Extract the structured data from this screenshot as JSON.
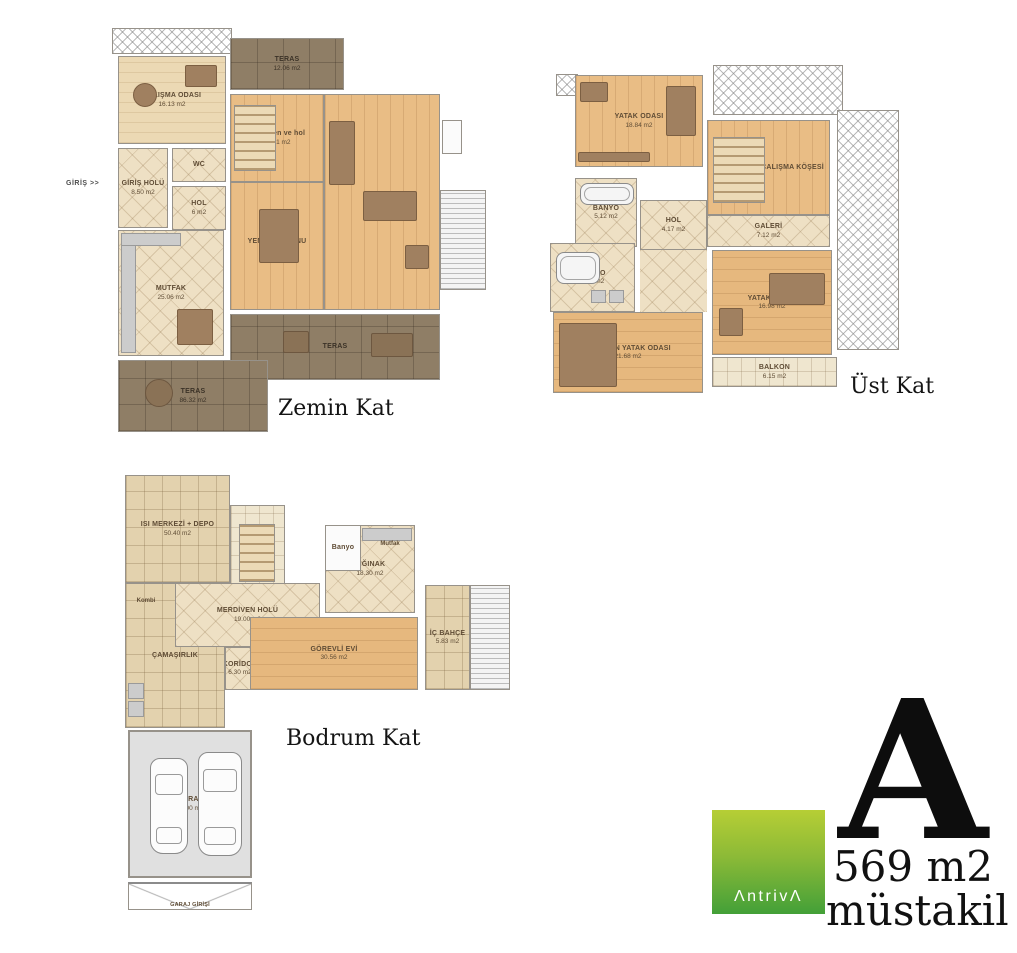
{
  "palette": {
    "wood": "#e9bd85",
    "wood_pale": "#ecd9b4",
    "tile": "#eee0c4",
    "terrace": "#8f7e66",
    "garage_floor": "#e0e0e0",
    "logo_green_top": "#b6ce35",
    "logo_green_bottom": "#43a038"
  },
  "logo": {
    "brand": "ΛntrivΛ",
    "unit_letter": "A",
    "unit_area": "569 m2",
    "unit_type": "müstakil"
  },
  "floors": {
    "zemin": {
      "title": "Zemin Kat",
      "entry": "GİRİŞ >>",
      "rooms": {
        "calisma": {
          "label": "ÇALIŞMA ODASI",
          "area": "16.13 m2"
        },
        "teras_ust": {
          "label": "TERAS",
          "area": "12.06 m2"
        },
        "merdiven": {
          "label": "merdiven ve hol",
          "area": "17.21 m2"
        },
        "yasama": {
          "label": "YAŞAMA",
          "area": "48.37 m2"
        },
        "yemek": {
          "label": "YEMEK SALONU",
          "area": "21.29 m2"
        },
        "wc": {
          "label": "WC"
        },
        "giris_holu": {
          "label": "GİRİŞ HOLÜ",
          "area": "8.50 m2"
        },
        "hol": {
          "label": "HOL",
          "area": "6 m2"
        },
        "mutfak": {
          "label": "MUTFAK",
          "area": "25.06 m2"
        },
        "teras_orta": {
          "label": "TERAS"
        },
        "teras_alt": {
          "label": "TERAS",
          "area": "86.32 m2"
        }
      }
    },
    "ust": {
      "title": "Üst Kat",
      "rooms": {
        "yatak1": {
          "label": "YATAK ODASI",
          "area": "18.84 m2"
        },
        "calisma_kosesi": {
          "label": "ÇALIŞMA KÖŞESİ"
        },
        "banyo1": {
          "label": "BANYO",
          "area": "5.12 m2"
        },
        "hol": {
          "label": "HOL",
          "area": "4.17 m2"
        },
        "galeri": {
          "label": "GALERİ",
          "area": "7.12 m2"
        },
        "banyo2": {
          "label": "BANYO",
          "area": "6.04 m2"
        },
        "ebeveyn": {
          "label": "EBEVEYN YATAK ODASI",
          "area": "21.68 m2"
        },
        "yatak2": {
          "label": "YATAK ODASI",
          "area": "16.98 m2"
        },
        "balkon": {
          "label": "BALKON",
          "area": "6.15 m2"
        }
      }
    },
    "bodrum": {
      "title": "Bodrum Kat",
      "rooms": {
        "isi_merkezi": {
          "label": "ISI MERKEZİ + DEPO",
          "area": "50.40 m2"
        },
        "merdiven": {
          "label": "8 m2"
        },
        "merdiven_holu": {
          "label": "MERDİVEN HOLÜ",
          "area": "19.00 m2"
        },
        "banyo": {
          "label": "Banyo"
        },
        "mutfak": {
          "label": "Mutfak"
        },
        "siginak": {
          "label": "SIĞINAK",
          "area": "18.30 m2"
        },
        "koridor": {
          "label": "KORİDOR",
          "area": "6.30 m2"
        },
        "camasirlik": {
          "label": "ÇAMAŞIRLIK"
        },
        "kombi": {
          "label": "Kombi"
        },
        "gorevli_evi": {
          "label": "GÖREVLİ EVİ",
          "area": "30.56 m2"
        },
        "ic_bahce": {
          "label": "İÇ BAHÇE",
          "area": "5.83 m2"
        },
        "garaj": {
          "label": "GARAJ",
          "area": "45.00 m2"
        },
        "garaj_girisi": {
          "label": "GARAJ GİRİŞİ"
        }
      }
    }
  }
}
